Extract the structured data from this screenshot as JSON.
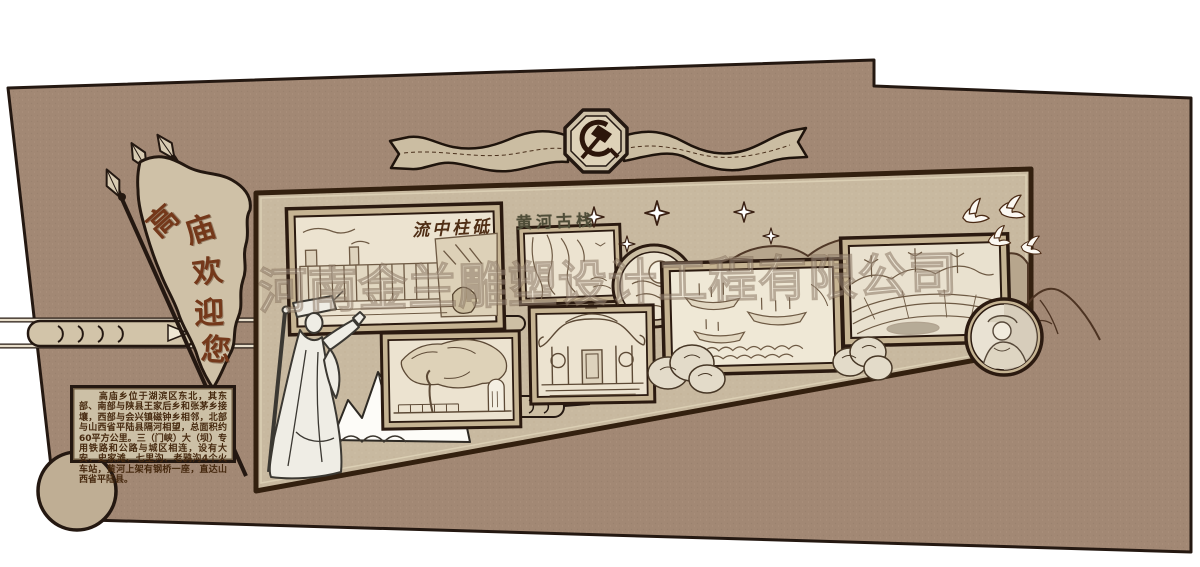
{
  "watermark": {
    "text": "河南金兰雕塑设计工程有限公司"
  },
  "banner": {
    "emblem_icon": "hammer-sickle",
    "style": "wavy-ribbon"
  },
  "welcome_flag": {
    "text": "高庙欢迎您",
    "chars": [
      "高",
      "庙",
      "欢",
      "迎",
      "您"
    ]
  },
  "intro_panel": {
    "text": "　　高庙乡位于湖滨区东北，其东部、南部与陕县王家后乡和张茅乡接壤，西部与会兴镇磁钟乡相邻，北部与山西省平陆县隔河相望，总面积约60平方公里。三（门峡）大（坝）专用铁路和公路与城区相连，设有大安、史家滩、七里沟、老鸦沟4个火车站，黄河上架有钢桥一座，直达山西省平陆县。"
  },
  "pictures": {
    "dam": {
      "title": "流中柱砥",
      "subject": "dam-and-river-sketch"
    },
    "plank_road": {
      "title": "黄河古栈",
      "subject": "cliff-plank-road-sketch"
    },
    "moon_medallion": {
      "subject": "moon-and-clouds-sketch"
    },
    "temple": {
      "subject": "temple-hall-sketch"
    },
    "boats": {
      "subject": "boats-on-waves-sketch"
    },
    "ancient_tree": {
      "subject": "old-tree-and-stele-sketch"
    },
    "terraces": {
      "subject": "terraced-fields-wind-turbines-sketch"
    },
    "portrait": {
      "subject": "farmer-portrait-photo"
    }
  },
  "icons": {
    "party_emblem": "hammer-sickle",
    "doves": "flying-doves",
    "sparkles": "four-point-stars",
    "spears": "pennant-spears",
    "cloud_scrolls": "auspicious-cloud-bars"
  },
  "palette": {
    "wall": "#a28874",
    "inner_panel": "#c8b9a0",
    "outline": "#241811",
    "paper": "#ece3d0",
    "flag_text": "#74381a",
    "seal_title": "#4f4d38"
  }
}
